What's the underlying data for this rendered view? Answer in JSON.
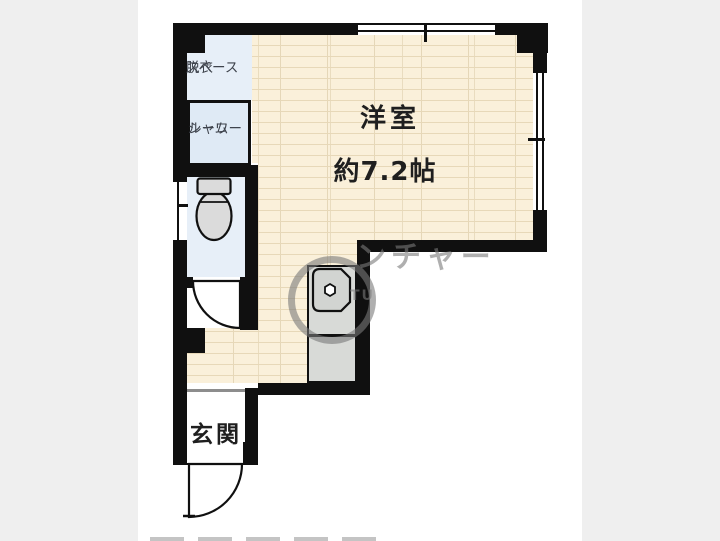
{
  "labels": {
    "dressing_line1": "脱衣",
    "dressing_line2": "スペース",
    "shower_line1": "シャワー",
    "shower_line2": "ルーム",
    "main_room_name": "洋室",
    "main_room_size": "約7.2帖",
    "entrance": "玄関"
  },
  "watermark": {
    "text": "ンチャー",
    "subtext": "TU"
  },
  "colors": {
    "background": "#efefef",
    "canvas": "#ffffff",
    "wall": "#101010",
    "floor_wood": "#faf0da",
    "floor_plank_line": "#e7d8b8",
    "wet_area": "#e7eff8",
    "shower_fill": "#dfeaf5",
    "counter": "#d8dad7",
    "sink": "#d2d4d1",
    "toilet_fixture": "#dbdbdb",
    "entrance_step": "#8d8d8d",
    "watermark": "rgba(122,122,122,0.6)",
    "label_dark": "#1f1f1f",
    "label_gray": "#3e434c"
  }
}
